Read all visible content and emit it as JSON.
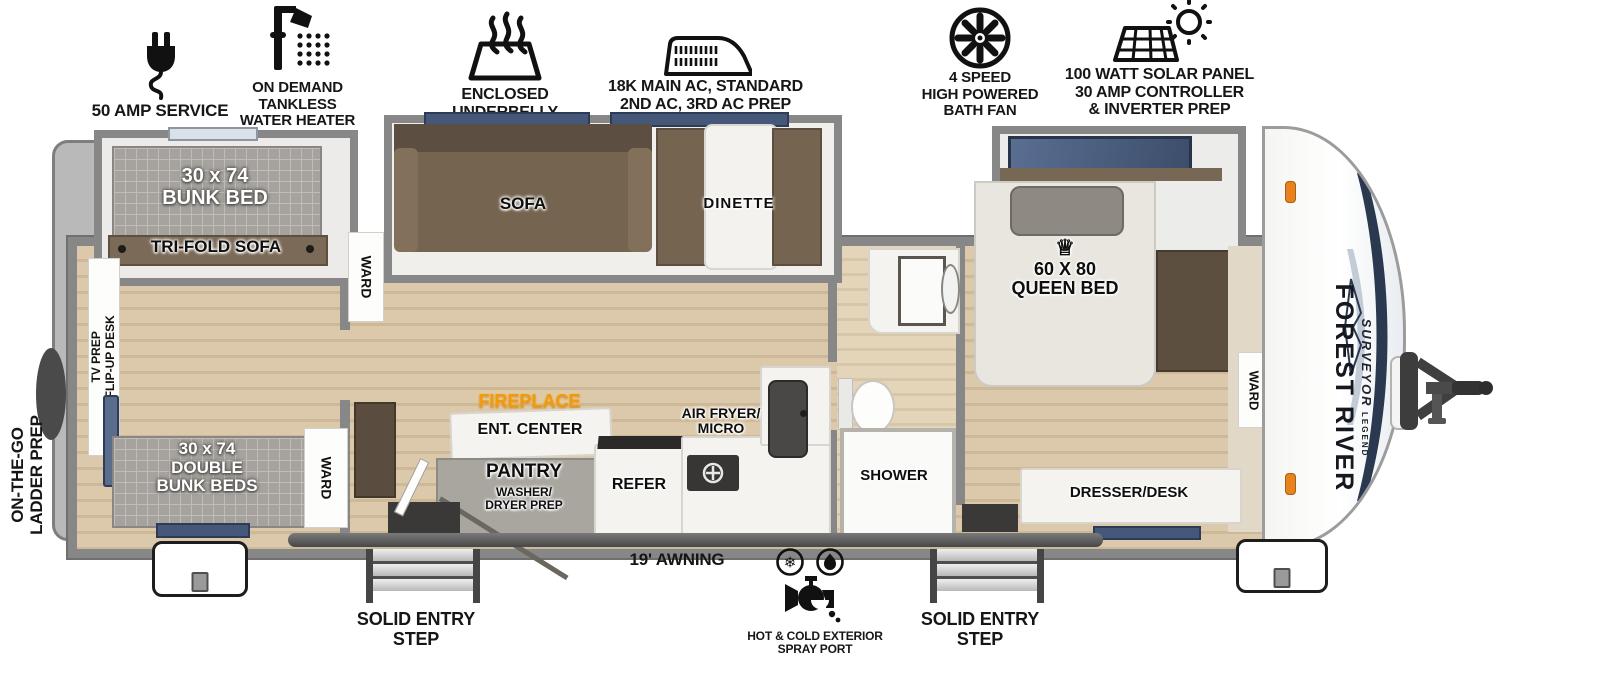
{
  "features": {
    "amp_service": "50 AMP SERVICE",
    "water_heater": "ON DEMAND\nTANKLESS\nWATER HEATER",
    "underbelly": "ENCLOSED UNDERBELLY\nW/ FORCED HEAT",
    "ac": "18K MAIN AC, STANDARD\n2ND AC, 3RD AC PREP",
    "bath_fan": "4 SPEED\nHIGH POWERED\nBATH FAN",
    "solar": "100 WATT SOLAR PANEL\n30 AMP CONTROLLER\n& INVERTER PREP"
  },
  "rooms": {
    "bunk_bed": "30 x 74\nBUNK BED",
    "tri_fold_sofa": "TRI-FOLD SOFA",
    "tv_prep": "TV PREP\nFLIP-UP DESK",
    "double_bunk": "30 x 74\nDOUBLE\nBUNK BEDS",
    "ward": "WARD",
    "sofa": "SOFA",
    "dinette": "DINETTE",
    "fireplace": "FIREPLACE",
    "ent_center": "ENT. CENTER",
    "pantry": "PANTRY",
    "pantry_prep": "WASHER/\nDRYER PREP",
    "refer": "REFER",
    "air_fryer_micro": "AIR FRYER/\nMICRO",
    "shower": "SHOWER",
    "queen_bed": "60 X 80\nQUEEN BED",
    "dresser_desk": "DRESSER/DESK"
  },
  "exterior": {
    "ladder_prep": "ON-THE-GO\nLADDER PREP",
    "awning": "19' AWNING",
    "entry_step": "SOLID ENTRY\nSTEP",
    "spray_port": "HOT & COLD EXTERIOR\nSPRAY PORT"
  },
  "branding": {
    "make": "FOREST RIVER",
    "model": "SURVEYOR",
    "trim": "LEGEND"
  },
  "icons": {
    "crown": "♕",
    "snowflake": "❄"
  },
  "colors": {
    "wall": "#878787",
    "floor": "#d8c5a6",
    "fireplace_accent": "#f09a10",
    "window": "#46587a",
    "sofa_brown": "#74634f",
    "mattress_gray": "#a6a29e"
  }
}
